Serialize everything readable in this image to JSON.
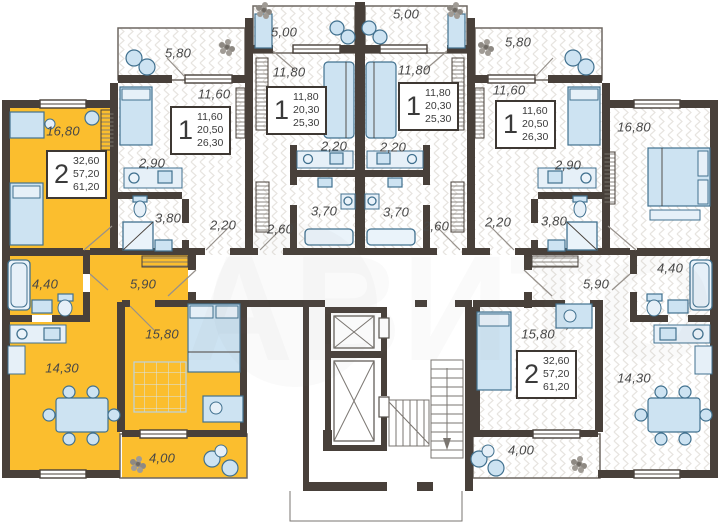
{
  "watermark": {
    "text": "АВИТО"
  },
  "colors": {
    "highlight": "#fbbe2e",
    "wall": "#48403a"
  },
  "apartments": [
    {
      "id": "left-2room",
      "highlighted": true,
      "stats": {
        "rooms": "2",
        "living": "32,60",
        "area": "57,20",
        "total": "61,20"
      },
      "rooms": {
        "bedroom1": "16,80",
        "bathroom": "4,40",
        "hallway": "5,90",
        "kitchen_living": "14,30",
        "bedroom2": "15,80",
        "balcony": "4,00"
      }
    },
    {
      "id": "second-1room",
      "highlighted": false,
      "stats": {
        "rooms": "1",
        "living": "11,60",
        "area": "20,50",
        "total": "26,30"
      },
      "rooms": {
        "balcony": "5,80",
        "room": "11,60",
        "kitchen": "2,90",
        "bathroom": "3,80",
        "hallway": "2,20"
      }
    },
    {
      "id": "third-1room",
      "highlighted": false,
      "stats": {
        "rooms": "1",
        "living": "11,80",
        "area": "20,30",
        "total": "25,30"
      },
      "rooms": {
        "balcony": "5,00",
        "room": "11,80",
        "kitchen": "2,20",
        "bathroom": "3,70",
        "hallway": "2,60"
      }
    },
    {
      "id": "fourth-1room",
      "highlighted": false,
      "stats": {
        "rooms": "1",
        "living": "11,80",
        "area": "20,30",
        "total": "25,30"
      },
      "rooms": {
        "balcony": "5,00",
        "room": "11,80",
        "kitchen": "2,20",
        "bathroom": "3,70",
        "hallway": "2,60"
      }
    },
    {
      "id": "fifth-1room",
      "highlighted": false,
      "stats": {
        "rooms": "1",
        "living": "11,60",
        "area": "20,50",
        "total": "26,30"
      },
      "rooms": {
        "balcony": "5,80",
        "room": "11,60",
        "kitchen": "2,90",
        "bathroom": "3,80",
        "hallway": "2,20"
      }
    },
    {
      "id": "right-2room",
      "highlighted": false,
      "stats": {
        "rooms": "2",
        "living": "32,60",
        "area": "57,20",
        "total": "61,20"
      },
      "rooms": {
        "bedroom1": "16,80",
        "bathroom": "4,40",
        "hallway": "5,90",
        "kitchen_living": "14,30",
        "bedroom2": "15,80",
        "balcony": "4,00"
      }
    }
  ]
}
